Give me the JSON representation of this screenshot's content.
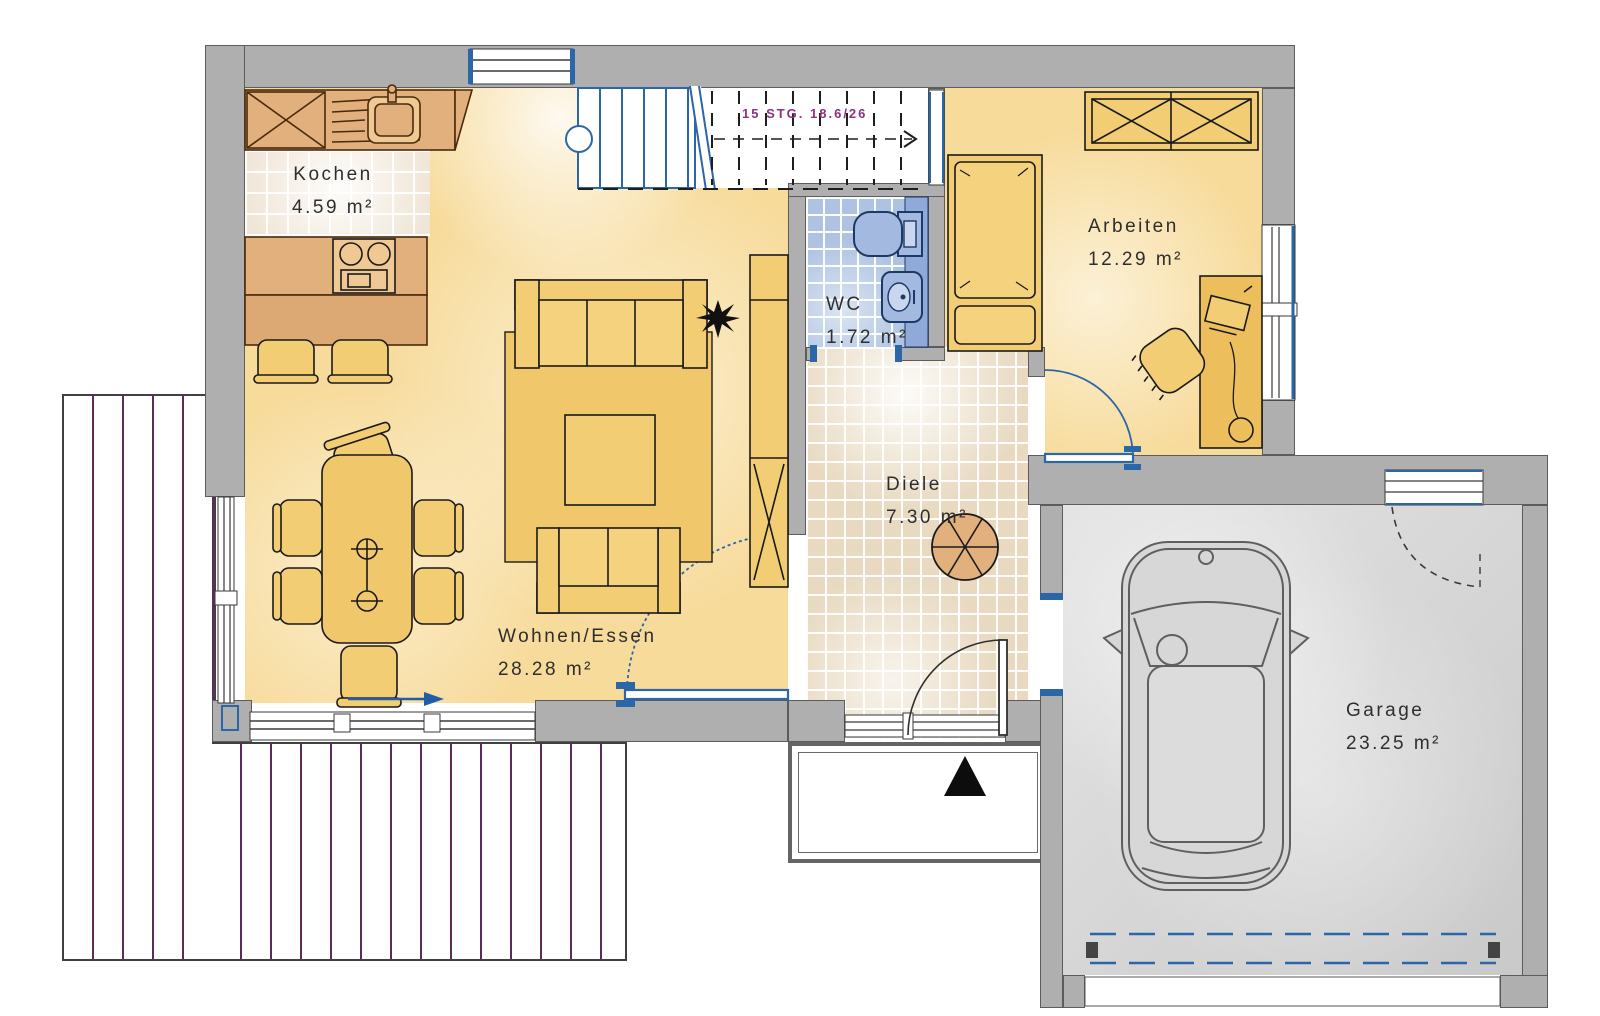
{
  "plan_title": "Erdgeschoss Grundriss",
  "rooms": {
    "kochen": {
      "label": "Kochen",
      "area": "4.59 m²"
    },
    "wohnen": {
      "label": "Wohnen/Essen",
      "area": "28.28 m²"
    },
    "wc": {
      "label": "WC",
      "area": "1.72 m²"
    },
    "diele": {
      "label": "Diele",
      "area": "7.30 m²"
    },
    "arbeiten": {
      "label": "Arbeiten",
      "area": "12.29 m²"
    },
    "garage": {
      "label": "Garage",
      "area": "23.25 m²"
    }
  },
  "stairs": {
    "note": "15 STG. 18.6/26"
  },
  "colors": {
    "room_fill": "#F7DB9B",
    "furniture_fill": "#F3CD74",
    "counter_fill": "#E2B07C",
    "wall_fill": "#AFAFAF",
    "wc_tile": "#AEC3E2",
    "diele_tile": "#E8D9C0",
    "kitchen_tile": "#F0E5D6",
    "terrace_stripe": "#5C2C5E",
    "door_window_blue": "#2B66A8",
    "stair_text": "#8E3180",
    "garage_floor": "#D9D9D9",
    "entrance_marker": "#0d0d0d"
  }
}
